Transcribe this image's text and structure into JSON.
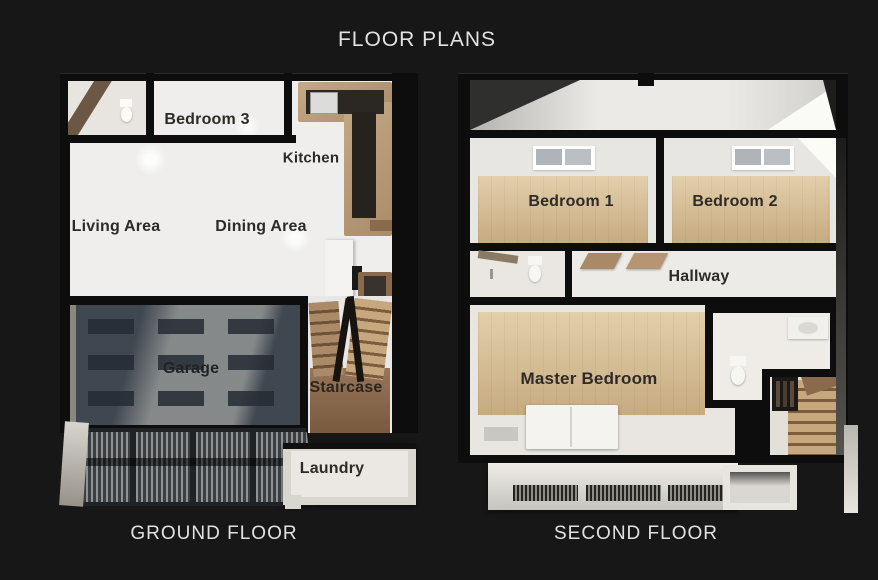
{
  "title": "FLOOR PLANS",
  "ground_floor": {
    "caption": "GROUND FLOOR",
    "rooms": {
      "bedroom3": "Bedroom 3",
      "kitchen": "Kitchen",
      "living": "Living Area",
      "dining": "Dining Area",
      "garage": "Garage",
      "staircase": "Staircase",
      "laundry": "Laundry"
    }
  },
  "second_floor": {
    "caption": "SECOND FLOOR",
    "rooms": {
      "bedroom1": "Bedroom 1",
      "bedroom2": "Bedroom 2",
      "hallway": "Hallway",
      "master_bedroom": "Master Bedroom"
    }
  },
  "colors": {
    "background": "#171717",
    "wall": "#0d0d0d",
    "floor_light": "#efeeec",
    "wood_floor": "#d6c1a0",
    "stair_wood": "#9c7b5c",
    "garage_floor": "#3f4750",
    "room_label_text": "#2e2b27",
    "heading_text": "#e2e2e2"
  }
}
